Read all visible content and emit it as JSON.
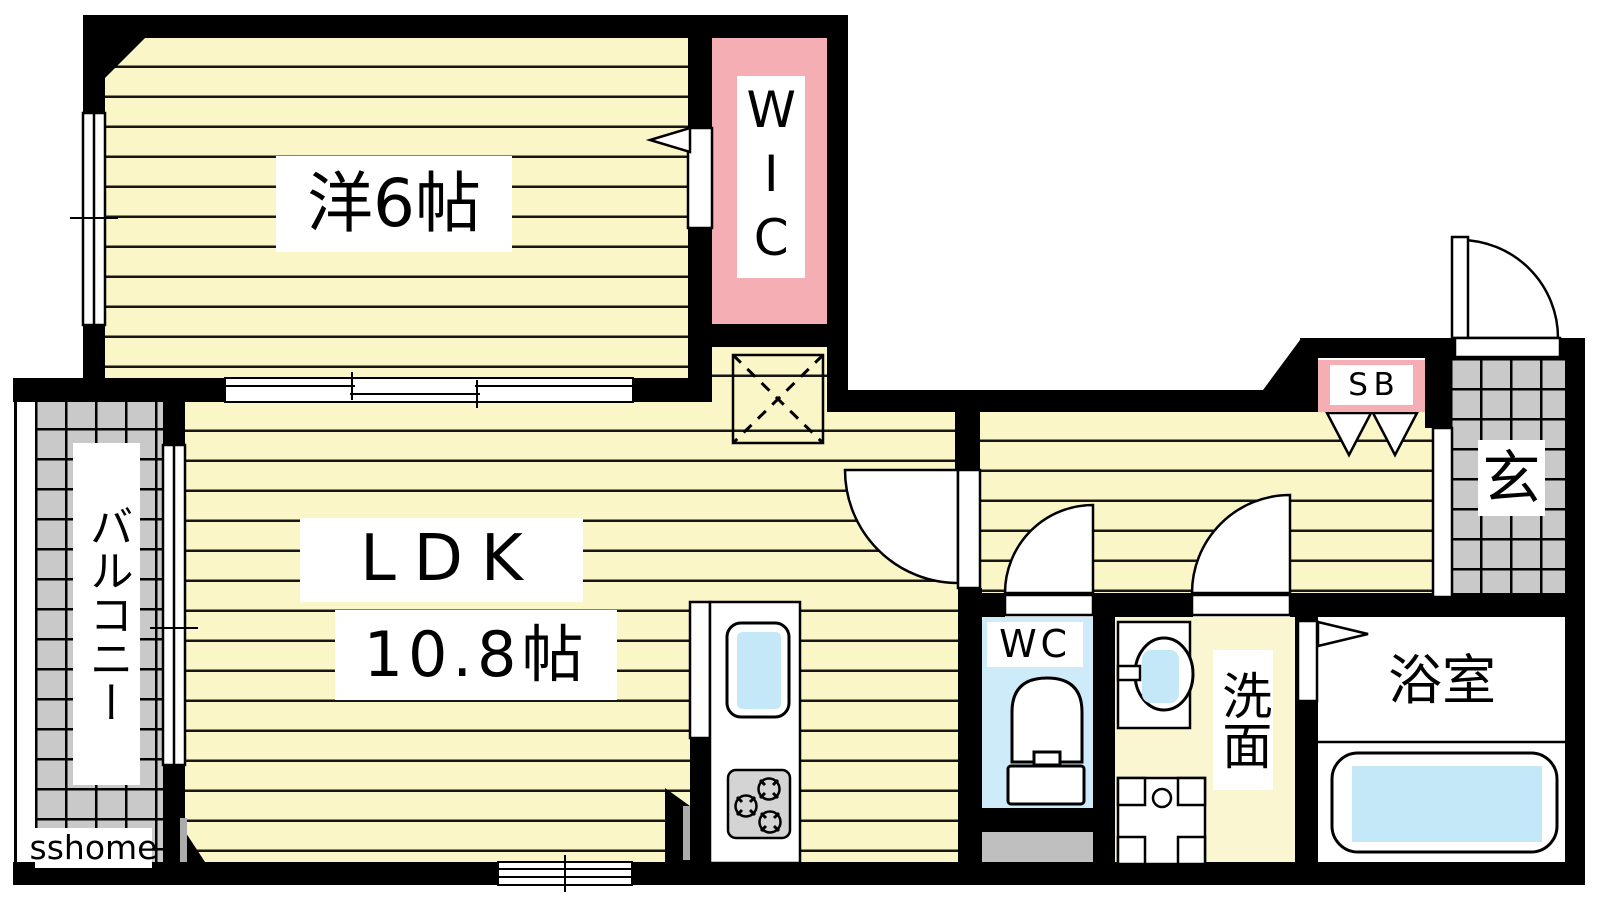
{
  "floorplan": {
    "title": "1LDK apartment floor plan",
    "watermark": "sshome",
    "labels": {
      "western_room": "洋6帖",
      "ldk": "LDK",
      "ldk_size": "10.8帖",
      "wic": "WIC",
      "balcony": "バルコニー",
      "hall_shoe_box": "SB",
      "entrance": "玄",
      "wc": "WC",
      "washroom": "洗面",
      "bathroom": "浴室"
    },
    "colors": {
      "wall": "#000000",
      "floor_yellow": "#FBF6C8",
      "washroom_yellow": "#FBF6D2",
      "closet_pink": "#F5AEB4",
      "water_blue": "#C5E8F8",
      "wc_floor_blue": "#CDEBF9",
      "tile_gray": "#C9C9C9",
      "step_gray": "#BFBFBF",
      "background": "#FFFFFF"
    },
    "fixtures": [
      "kitchen-counter",
      "kitchen-sink",
      "gas-stove",
      "refrigerator-space",
      "toilet",
      "washbasin",
      "washing-machine-pan",
      "bathtub",
      "entrance-door",
      "doors",
      "windows",
      "shoe-box-folding-doors"
    ]
  }
}
